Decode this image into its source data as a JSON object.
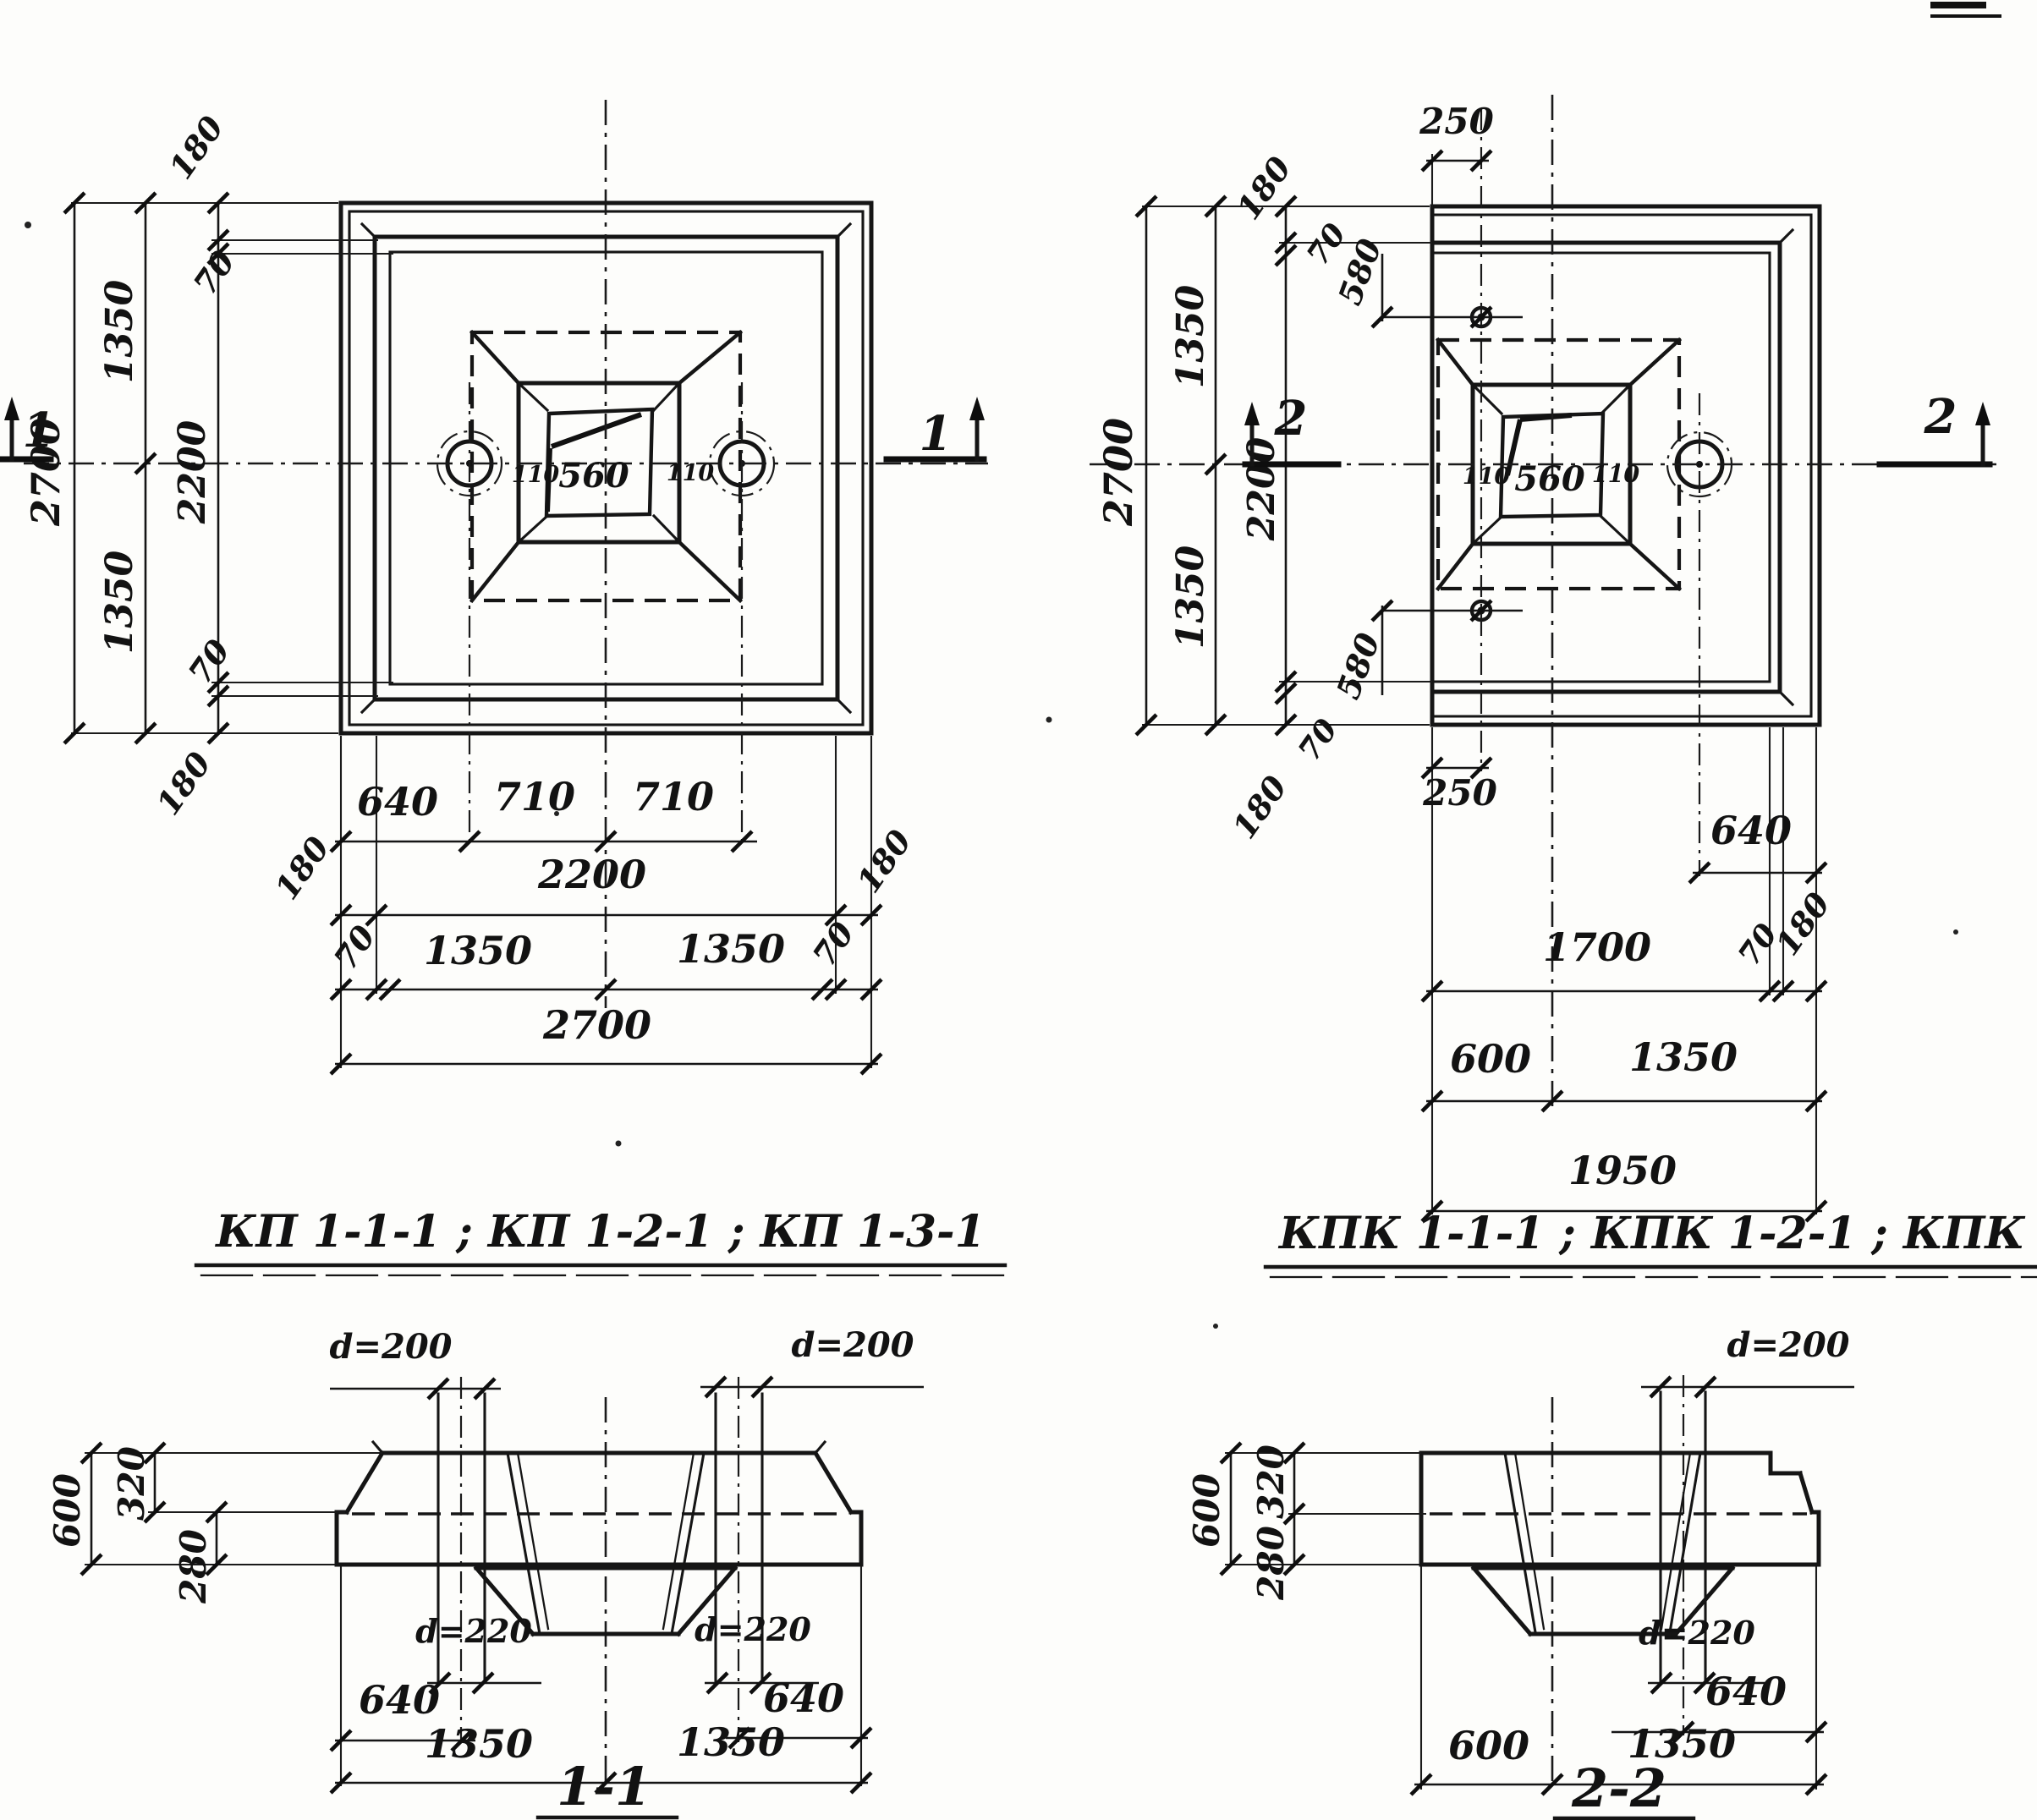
{
  "titles": {
    "left": "КП 1-1-1 ; КП 1-2-1 ;  КП 1-3-1",
    "right": "КПК 1-1-1 ; КПК 1-2-1 ; КПК 1-3-1"
  },
  "left_plan": {
    "mark_left": "1",
    "mark_right": "1",
    "socket_left": "110",
    "socket_center": "560",
    "socket_right": "110",
    "v2700": "2700",
    "v1350t": "1350",
    "v1350b": "1350",
    "v2200": "2200",
    "v180t": "180",
    "v70t": "70",
    "v70b": "70",
    "v180b": "180",
    "h640": "640",
    "h710a": "710",
    "h710b": "710",
    "h180l": "180",
    "h2200": "2200",
    "h180r": "180",
    "h70l": "70",
    "h1350l": "1350",
    "h1350r": "1350",
    "h70r": "70",
    "h2700": "2700"
  },
  "right_plan": {
    "mark_left": "2",
    "mark_right": "2",
    "t250": "250",
    "b250": "250",
    "socket_left": "110",
    "socket_center": "560",
    "socket_right": "110",
    "v2700": "2700",
    "v1350t": "1350",
    "v1350b": "1350",
    "v2200": "2200",
    "v180t": "180",
    "v70t": "70",
    "v580t": "580",
    "v70b": "70",
    "v180b": "180",
    "v580b": "580",
    "h640": "640",
    "h1700": "1700",
    "h70": "70",
    "h180": "180",
    "h600": "600",
    "h1350": "1350",
    "h1950": "1950"
  },
  "section11": {
    "d200_left": "d=200",
    "d200_right": "d=200",
    "v600": "600",
    "v320": "320",
    "v280": "280",
    "d220_left": "d=220",
    "d220_right": "d=220",
    "h640l": "640",
    "h640r": "640",
    "h1350l": "1350",
    "h1350r": "1350",
    "caption": "1-1"
  },
  "section22": {
    "d200": "d=200",
    "v600": "600",
    "v320": "320",
    "v280": "280",
    "d220": "d=220",
    "h640": "640",
    "h600": "600",
    "h1350": "1350",
    "caption": "2-2"
  }
}
